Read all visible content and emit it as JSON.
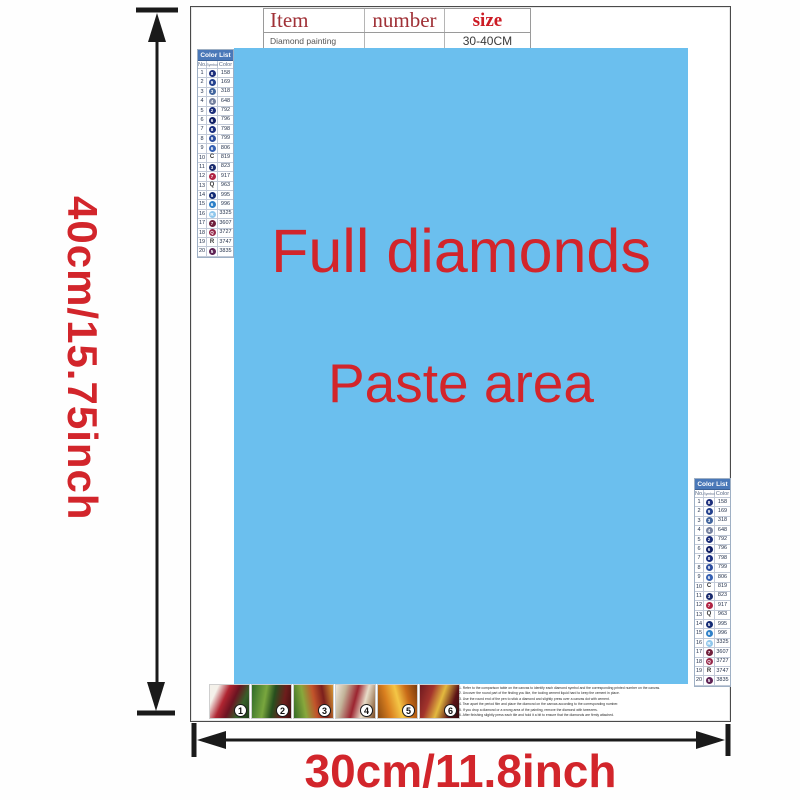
{
  "page": {
    "height_dim_label": "40cm/15.75inch",
    "width_dim_label": "30cm/11.8inch",
    "accent_red": "#d2252b",
    "paste_blue": "#6bbfee"
  },
  "item_table": {
    "col_item": "Item",
    "col_number": "number",
    "col_size": "size",
    "row_item": "Diamond painting",
    "row_number": "",
    "row_size": "30-40CM"
  },
  "paste_area": {
    "line1": "Full diamonds",
    "line2": "Paste area"
  },
  "color_list": {
    "title": "Color List",
    "col_no": "No.",
    "col_symbol": "Symbol",
    "col_color": "Color",
    "rows": [
      {
        "no": "1",
        "glyph": "8",
        "circle": "#1c2e7c",
        "code": "158"
      },
      {
        "no": "2",
        "glyph": "9",
        "circle": "#23418e",
        "code": "169"
      },
      {
        "no": "3",
        "glyph": "3",
        "circle": "#41659e",
        "code": "318"
      },
      {
        "no": "4",
        "glyph": "4",
        "circle": "#75819f",
        "code": "648"
      },
      {
        "no": "5",
        "glyph": "2",
        "circle": "#1a2d7a",
        "code": "792"
      },
      {
        "no": "6",
        "glyph": "6",
        "circle": "#101f66",
        "code": "796"
      },
      {
        "no": "7",
        "glyph": "8",
        "circle": "#1b2f80",
        "code": "798"
      },
      {
        "no": "8",
        "glyph": "9",
        "circle": "#2c4d9e",
        "code": "799"
      },
      {
        "no": "9",
        "glyph": "6",
        "circle": "#3560b2",
        "code": "806"
      },
      {
        "no": "10",
        "glyph": "C",
        "circle": null,
        "code": "819"
      },
      {
        "no": "11",
        "glyph": "3",
        "circle": "#1a2c6e",
        "code": "823"
      },
      {
        "no": "12",
        "glyph": "7",
        "circle": "#b02444",
        "code": "917"
      },
      {
        "no": "13",
        "glyph": "Q",
        "circle": null,
        "code": "963"
      },
      {
        "no": "14",
        "glyph": "5",
        "circle": "#132a74",
        "code": "995"
      },
      {
        "no": "15",
        "glyph": "6",
        "circle": "#2e80c8",
        "code": "996"
      },
      {
        "no": "16",
        "glyph": "R",
        "circle": "#8fc7ec",
        "code": "3325"
      },
      {
        "no": "17",
        "glyph": "7",
        "circle": "#70203c",
        "code": "3607"
      },
      {
        "no": "18",
        "glyph": "Q",
        "circle": "#96284a",
        "code": "3727"
      },
      {
        "no": "19",
        "glyph": "R",
        "circle": null,
        "code": "3747"
      },
      {
        "no": "20",
        "glyph": "5",
        "circle": "#5e2254",
        "code": "3835"
      }
    ]
  },
  "thumbnails": [
    {
      "label": "1"
    },
    {
      "label": "2"
    },
    {
      "label": "3"
    },
    {
      "label": "4"
    },
    {
      "label": "5"
    },
    {
      "label": "6"
    }
  ],
  "instructions": {
    "lines": [
      "1. Refer to the comparison table on the canvas to identify each diamond symbol and the corresponding printed number on the canvas.",
      "2. Uncover the round part of the finding you like, the tooling cement liquid hard to keep the cement in place.",
      "3. Use the round end of the pen to stick a diamond and slightly press over a canvas dot with cement.",
      "4. Tear apart the period film and place the diamond on the canvas according to the corresponding number.",
      "5. If you drop a diamond or a wrong area of the painting, remove the diamond with tweezers.",
      "6. After finishing slightly press each tile and hold it a bit to ensure that the diamonds are firmly attached."
    ]
  }
}
